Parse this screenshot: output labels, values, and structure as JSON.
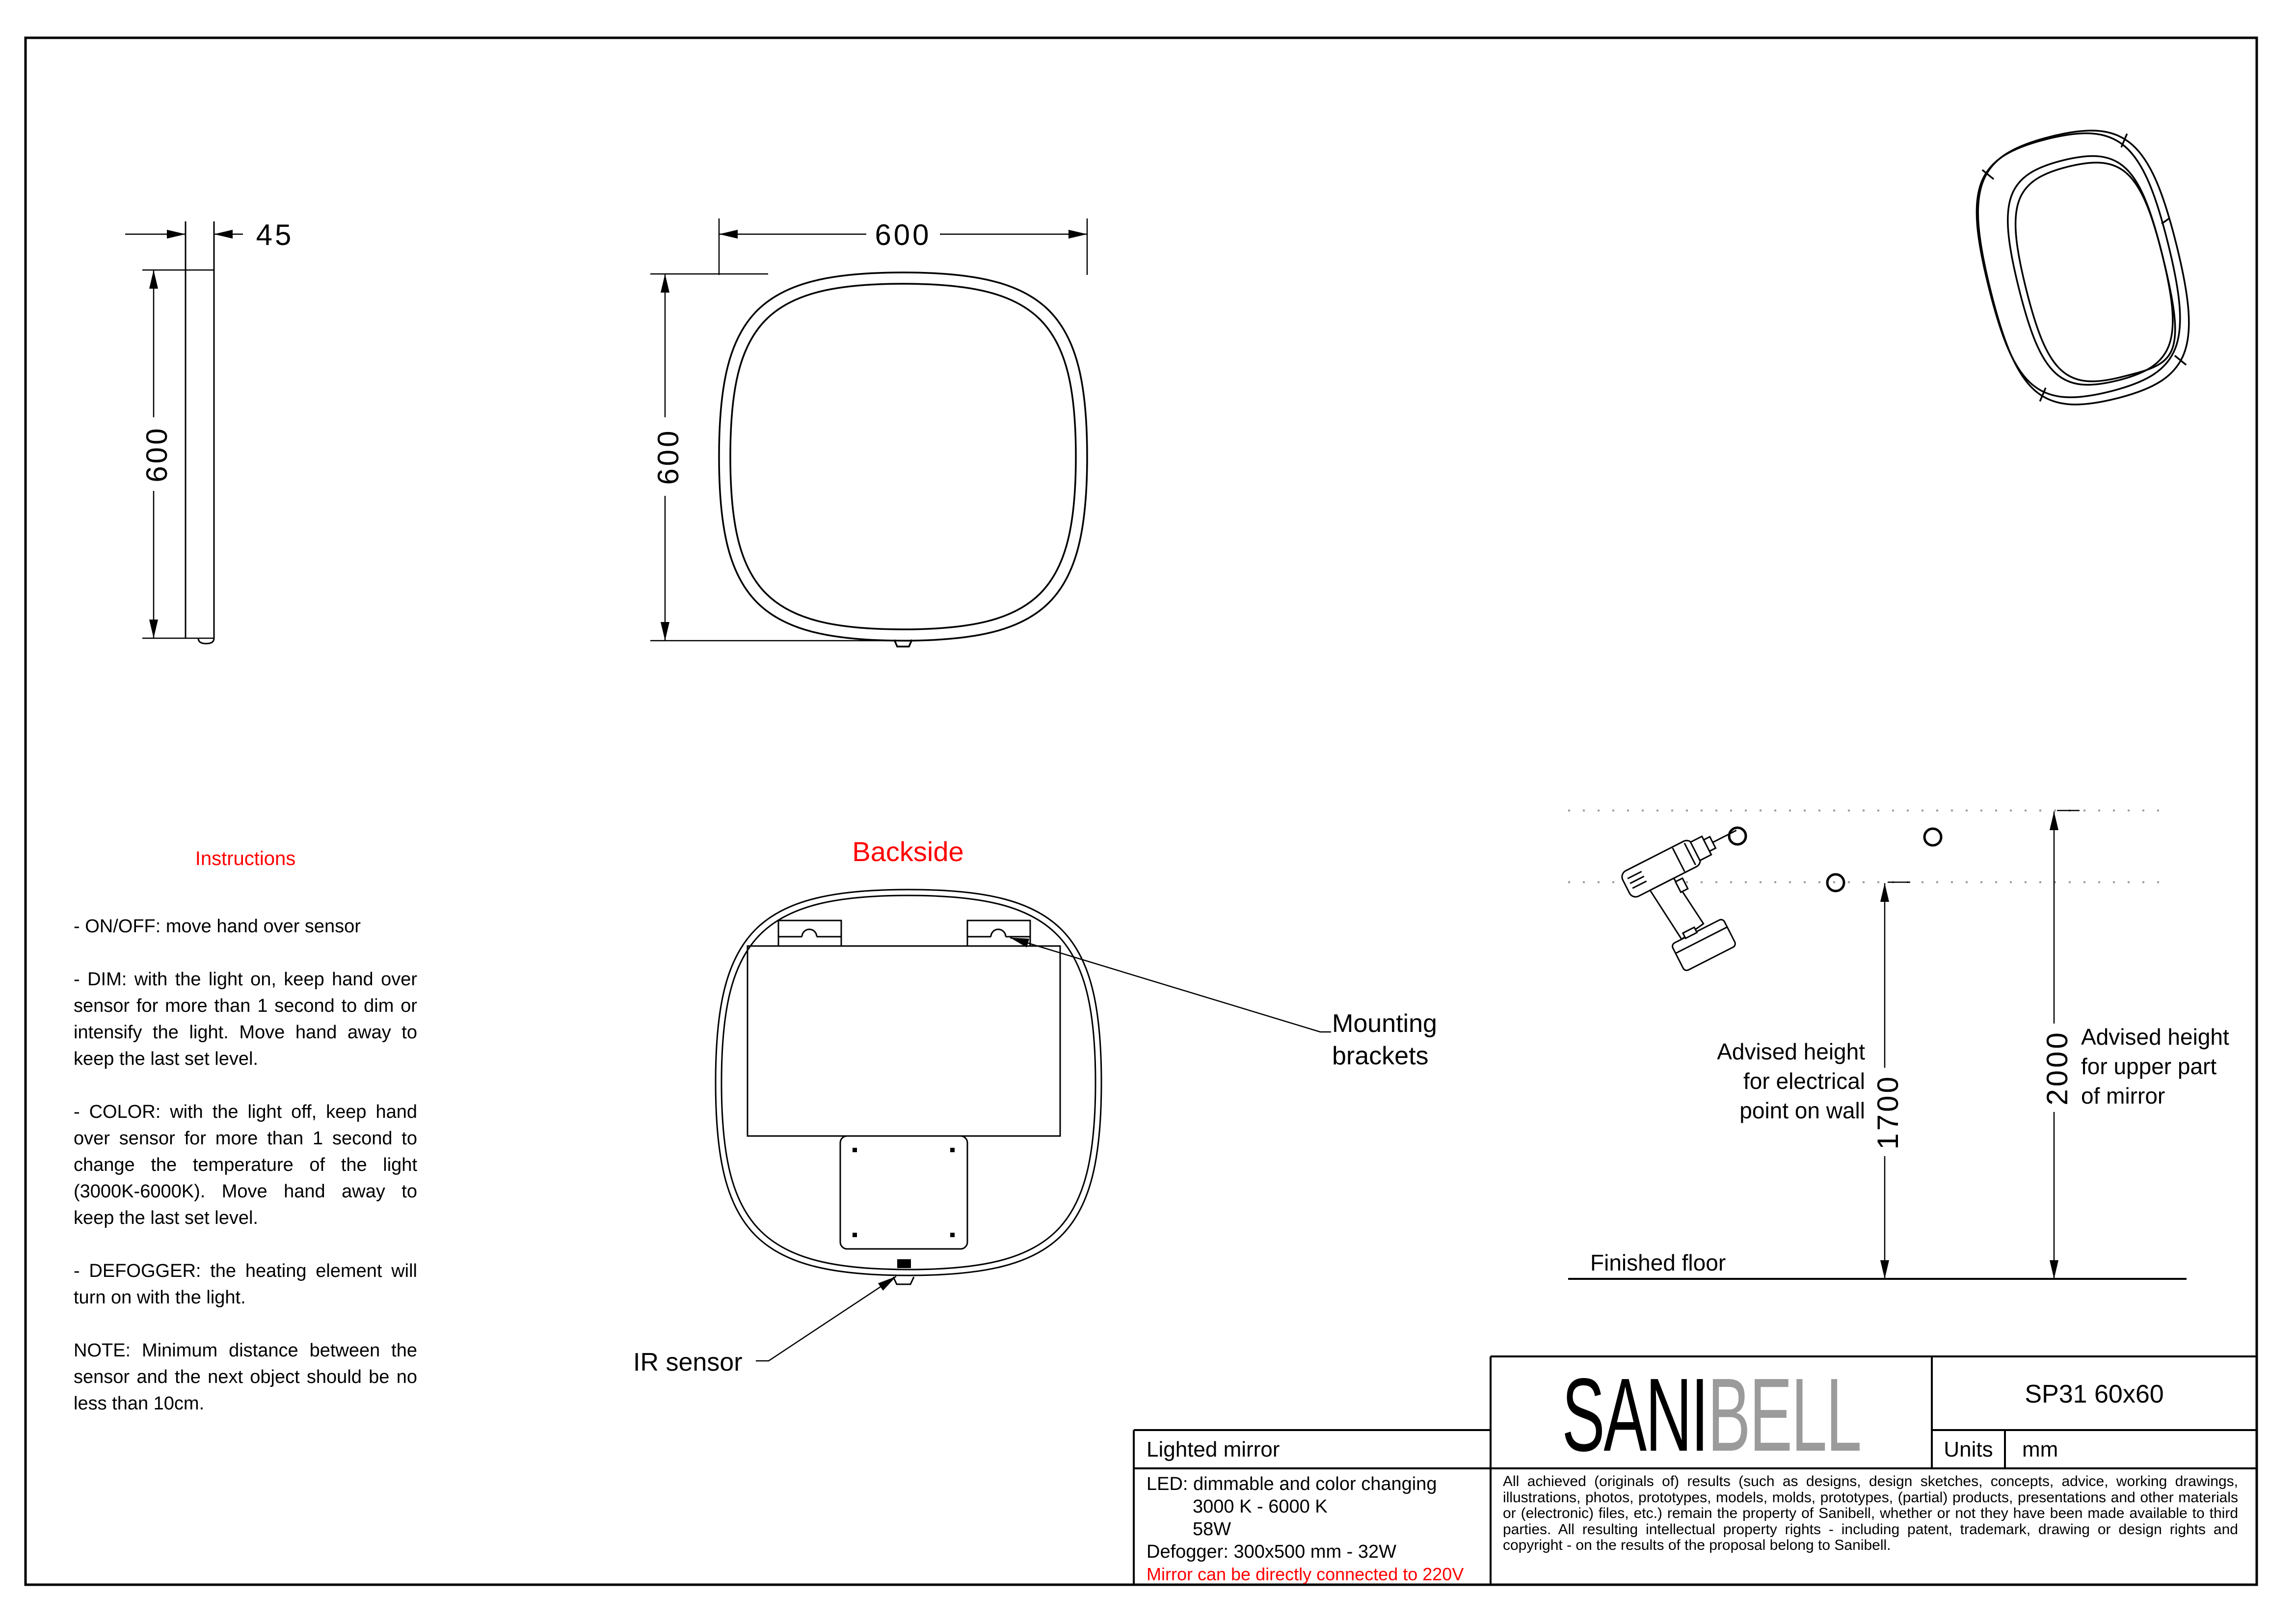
{
  "document": {
    "product_type": "Lighted mirror",
    "model": "SP31 60x60",
    "units_label": "Units",
    "units_value": "mm"
  },
  "brand": {
    "name_black": "SANI",
    "name_gray": "BELL",
    "gray_color": "#9b9b9b",
    "accent_red": "#ff0000"
  },
  "dimensions": {
    "side_thickness": "45",
    "side_height": "600",
    "front_width": "600",
    "front_height": "600",
    "electrical_point_height": "1700",
    "mirror_upper_height": "2000"
  },
  "views": {
    "backside_title": "Backside",
    "mounting_label": "Mounting\nbrackets",
    "ir_label": "IR sensor"
  },
  "install": {
    "electrical_note": "Advised height\nfor electrical\npoint on wall",
    "upper_note": "Advised height\nfor upper part\nof mirror",
    "floor_label": "Finished floor"
  },
  "instructions": {
    "title": "Instructions",
    "para_onoff": "- ON/OFF: move hand over sensor",
    "para_dim": "- DIM: with the light on, keep hand over sensor for more than 1 second to dim or intensify the light. Move hand away to keep the last set level.",
    "para_color": "- COLOR: with the light off, keep hand over sensor for more than 1 second to change the temperature of the light (3000K-6000K). Move hand away to keep the last set level.",
    "para_defogger": "- DEFOGGER: the heating element will turn on with the light.",
    "para_note": "NOTE: Minimum distance between the sensor and the next object should be no less than 10cm."
  },
  "specs": {
    "led_line1": "LED: dimmable and color changing",
    "led_line2": "3000 K - 6000 K",
    "led_line3": "58W",
    "defogger_line": "Defogger: 300x500 mm - 32W",
    "warning": "Mirror can be directly connected to 220V"
  },
  "legal": "All achieved (originals of) results (such as designs, design sketches, concepts, advice, working drawings, illustrations, photos, prototypes, models, molds, prototypes, (partial) products, presentations and other materials or (electronic) files, etc.) remain the property of Sanibell, whether or not they have been made available to third parties. All resulting intellectual property rights - including patent, trademark, drawing or design rights and copyright - on the results of the proposal belong to Sanibell."
}
